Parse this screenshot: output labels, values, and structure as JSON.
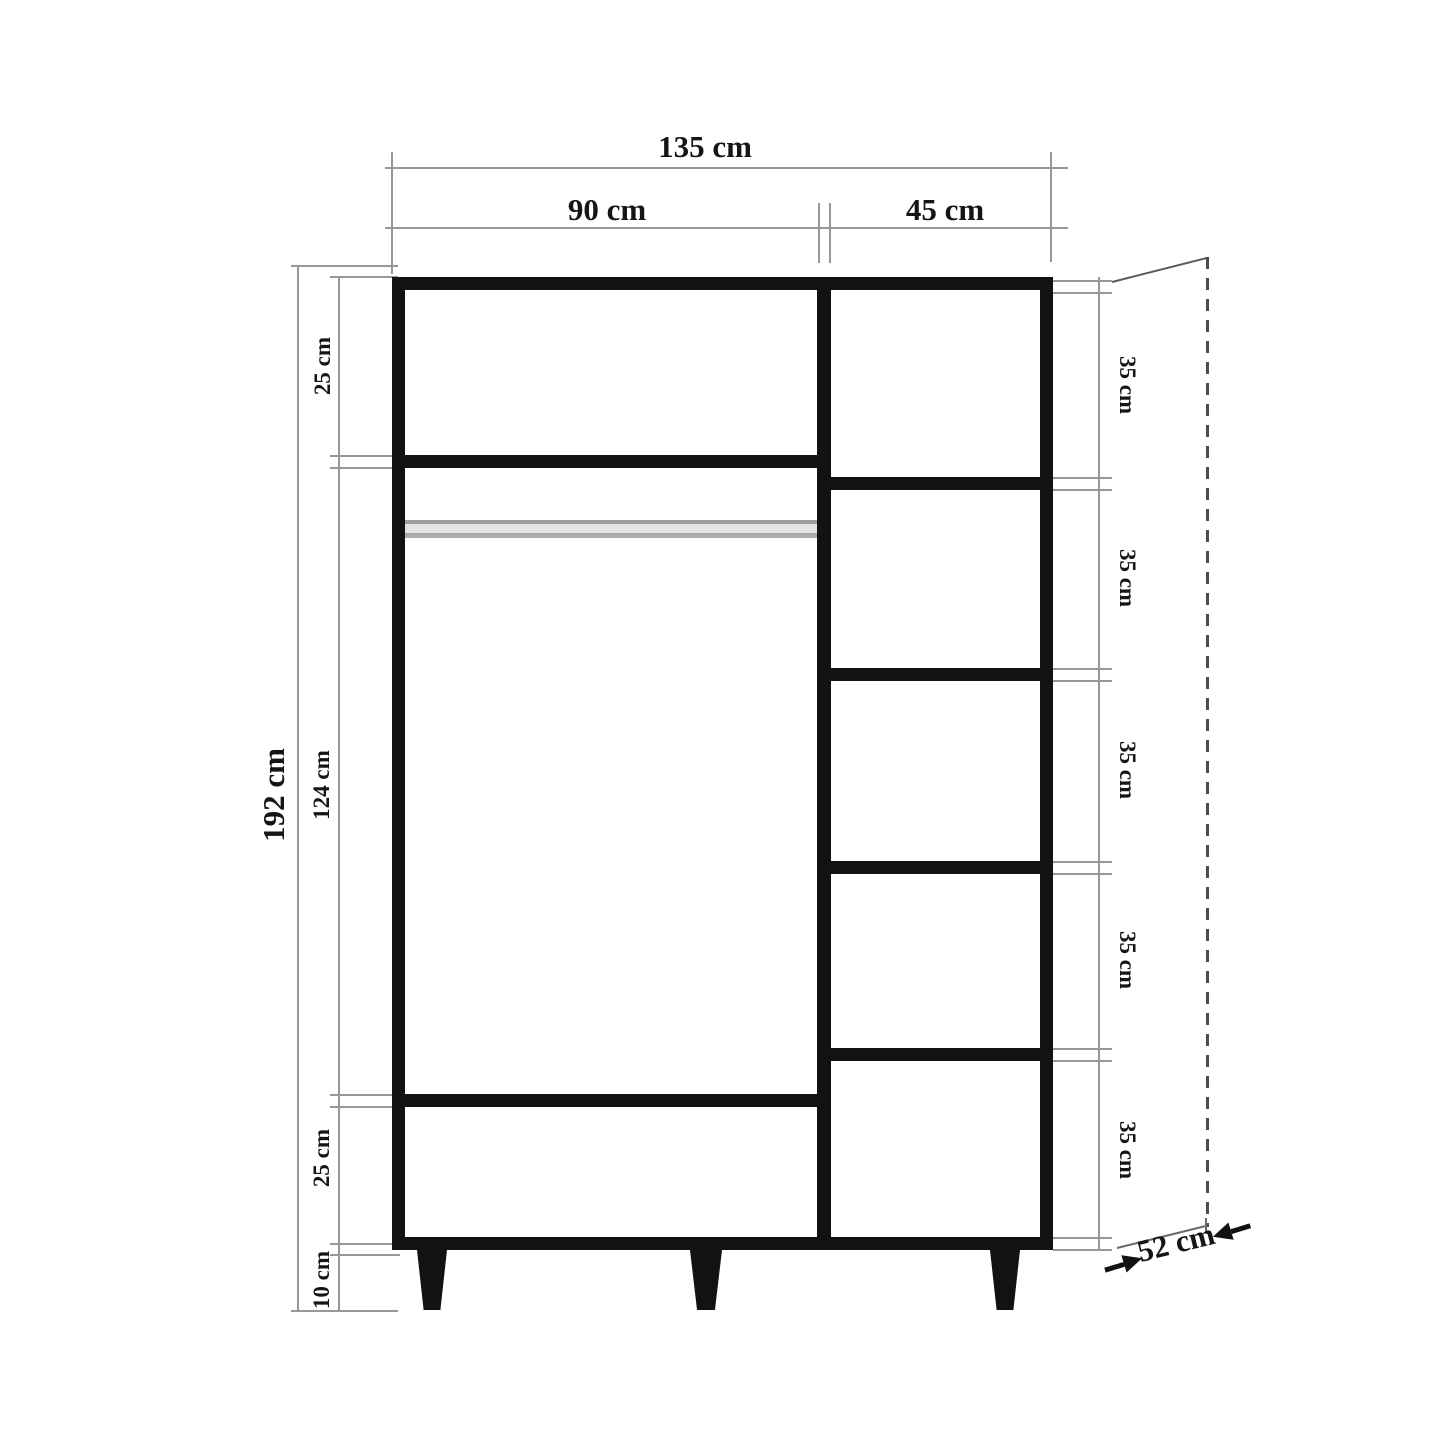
{
  "drawing": {
    "type": "wardrobe-technical-dimension-diagram",
    "unit": "cm",
    "labels": {
      "total_width": "135 cm",
      "left_section_width": "90 cm",
      "right_section_width": "45 cm",
      "total_height": "192 cm",
      "upper_left_section_height": "25 cm",
      "middle_left_section_height": "124 cm",
      "lower_left_section_height": "25 cm",
      "leg_height": "10 cm",
      "right_shelf_heights": [
        "35 cm",
        "35 cm",
        "35 cm",
        "35 cm",
        "35 cm"
      ],
      "depth": "52 cm"
    },
    "colors": {
      "background": "#ffffff",
      "outline": "#121212",
      "dimension_line": "#979797",
      "projection_line": "#4d4d4d",
      "hanging_rod_gray": "#ababab"
    },
    "structure": {
      "left_column_compartments": 3,
      "right_column_compartments": 5,
      "legs": 3,
      "has_hanging_rod": true
    }
  }
}
